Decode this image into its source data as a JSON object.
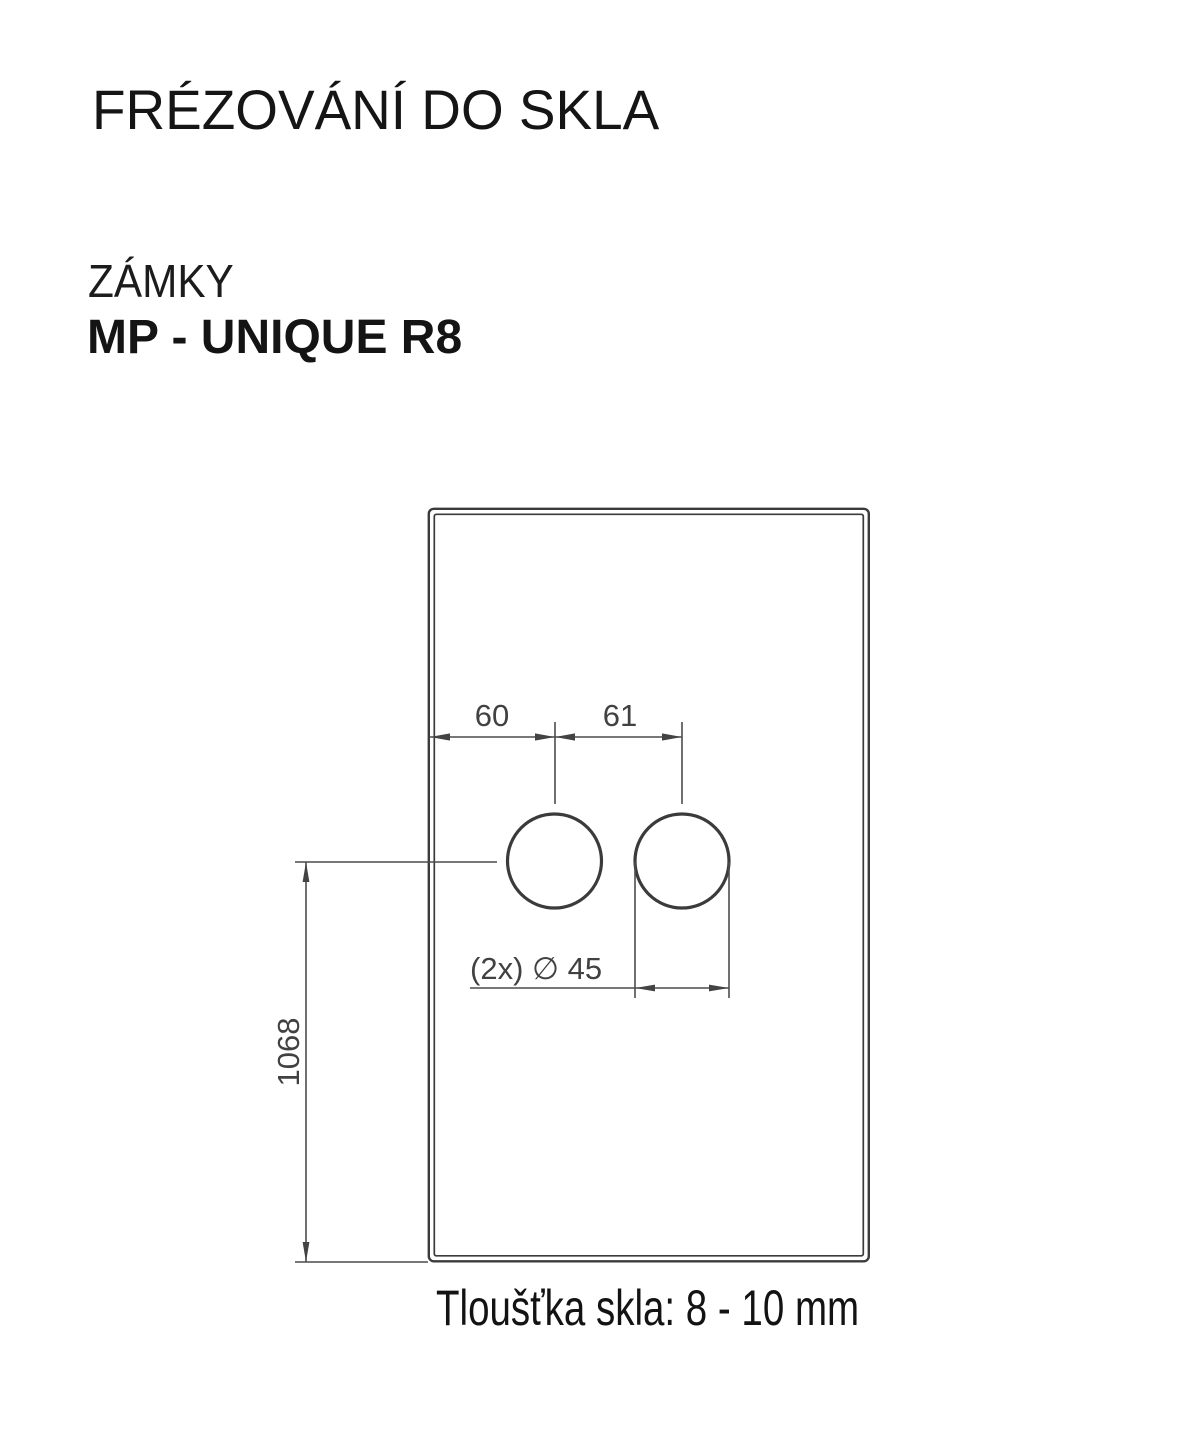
{
  "header": {
    "title": "FRÉZOVÁNÍ DO SKLA",
    "category": "ZÁMKY",
    "product": "MP - UNIQUE R8"
  },
  "drawing": {
    "dim_edge_to_hole": "60",
    "dim_hole_spacing": "61",
    "dim_hole_diameter": "(2x) ∅ 45",
    "dim_height": "1068",
    "note": "Tloušťka skla: 8 - 10 mm"
  },
  "colors": {
    "background": "#ffffff",
    "heading_text": "#151515",
    "drawing_line": "#3b3b3d",
    "dimension_line": "#4c4c4e",
    "dimension_text": "#414143"
  }
}
